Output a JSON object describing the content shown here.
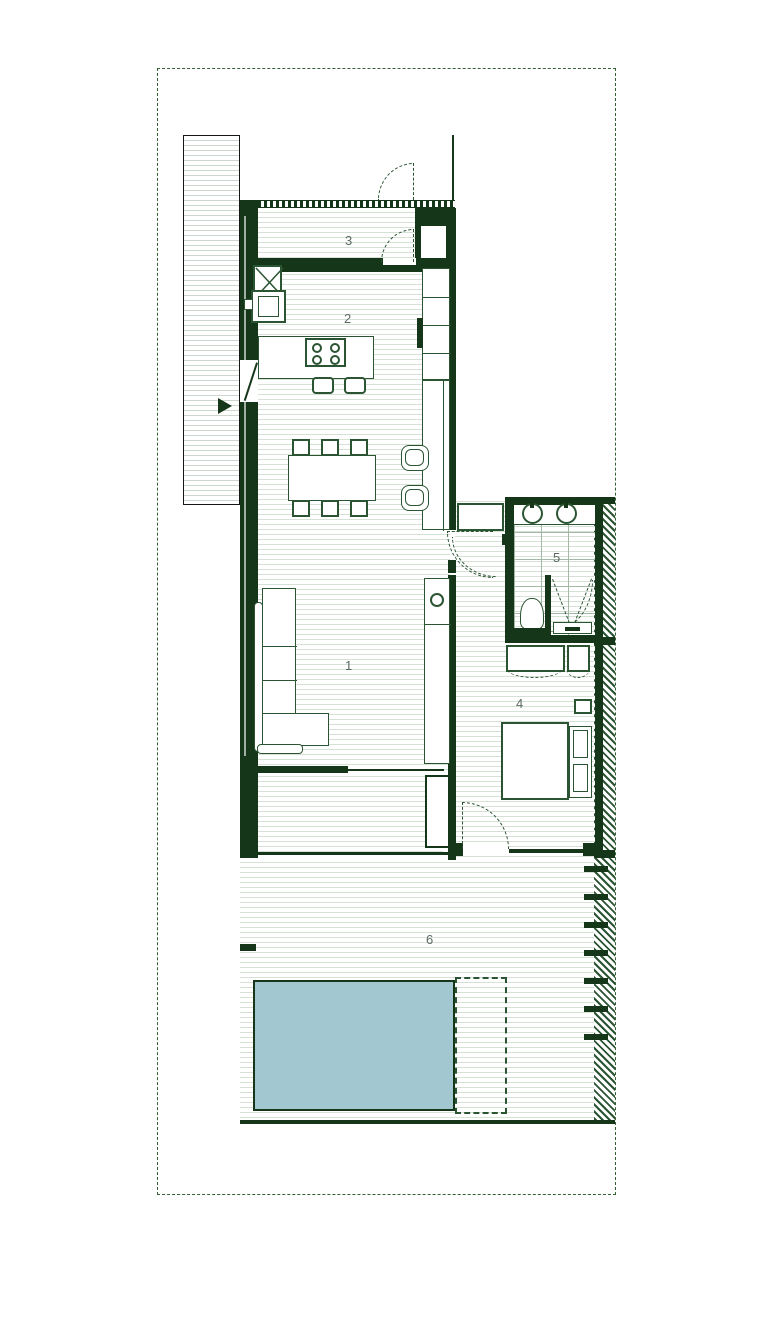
{
  "rooms": {
    "living": {
      "label": "1"
    },
    "kitchen": {
      "label": "2"
    },
    "entry": {
      "label": "3"
    },
    "bedroom": {
      "label": "4"
    },
    "bathroom": {
      "label": "5"
    },
    "terrace": {
      "label": "6"
    }
  },
  "colors": {
    "wall": "#16361a",
    "outline": "#2b5433",
    "floor_line": "#d6e0d5",
    "drive_line": "#ccd6cc",
    "tile_line": "#a3b9a6",
    "pool": "#a3c7d0",
    "boundary": "#356035",
    "label": "#5c6a64"
  }
}
